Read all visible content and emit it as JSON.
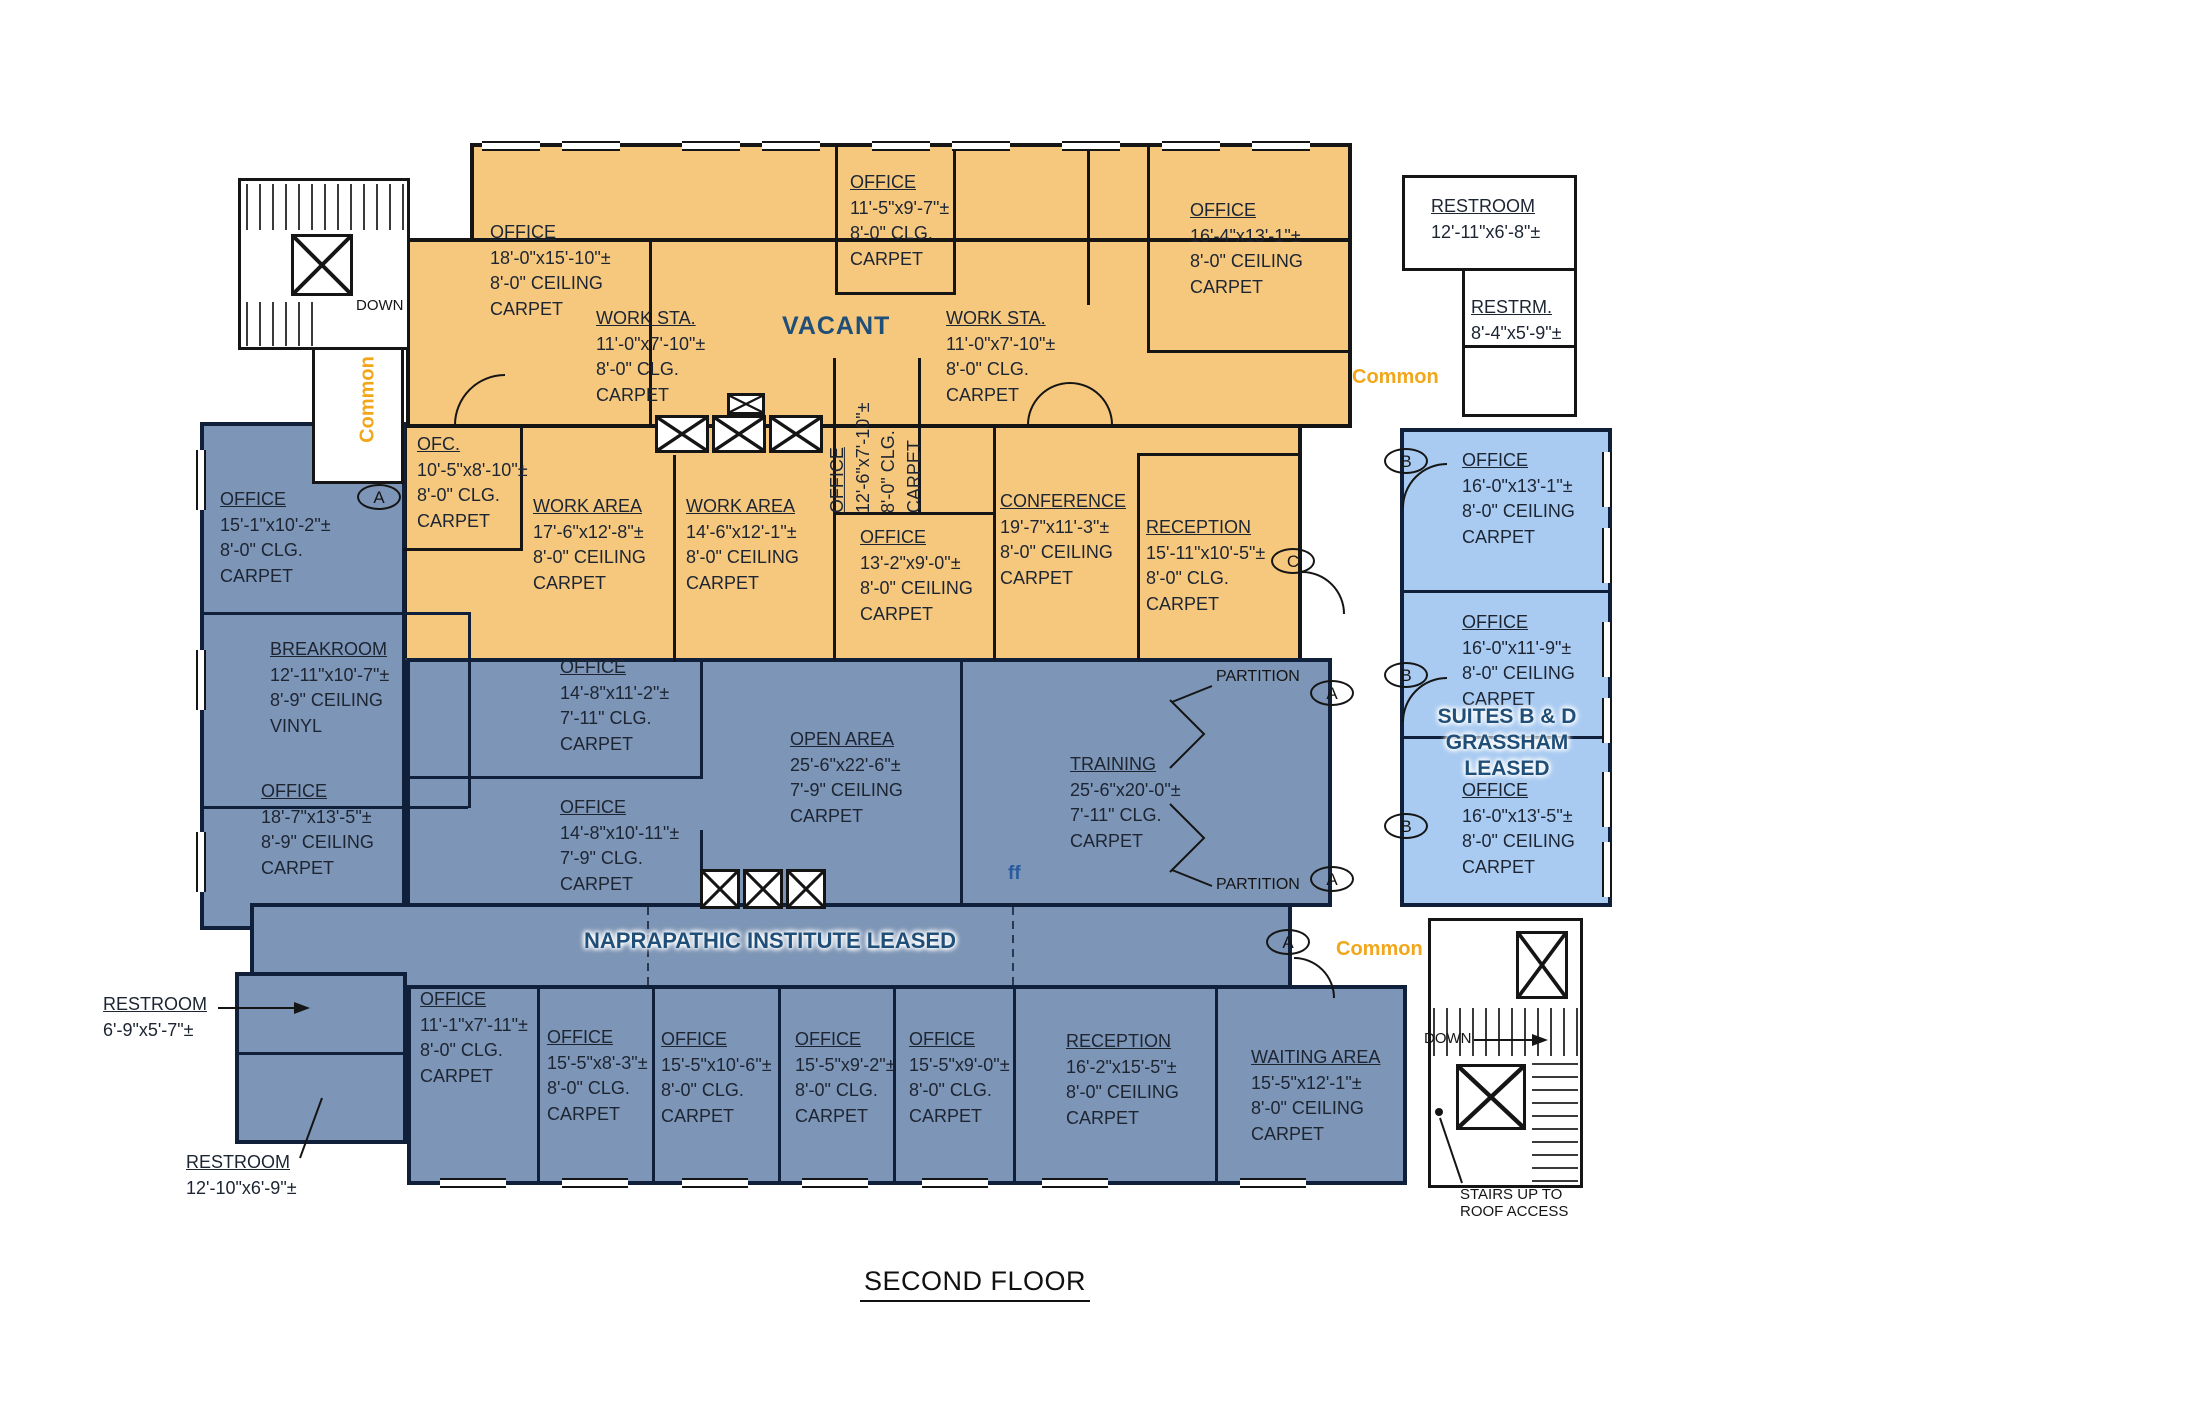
{
  "title": "SECOND FLOOR",
  "zones": {
    "vacant": {
      "name": "VACANT",
      "fill": "#F6C87E"
    },
    "naprapathic": {
      "name": "NAPRAPATHIC INSTITUTE LEASED",
      "fill": "#7D95B6"
    },
    "suites": {
      "line1": "SUITES B & D",
      "line2": "GRASSHAM",
      "line3": "LEASED",
      "fill": "#A9CBF2"
    }
  },
  "labels": {
    "common": "Common",
    "down": "DOWN",
    "partition": "PARTITION",
    "ff": "ff",
    "stairs_roof_line1": "STAIRS UP TO",
    "stairs_roof_line2": "ROOF ACCESS"
  },
  "markers": {
    "a": "A",
    "b": "B",
    "c": "C"
  },
  "rooms": [
    {
      "name": "OFFICE",
      "lines": [
        "18'-0\"x15'-10\"±",
        "8'-0\" CEILING",
        "CARPET"
      ]
    },
    {
      "name": "WORK STA.",
      "lines": [
        "11'-0\"x7'-10\"±",
        "8'-0\" CLG.",
        "CARPET"
      ]
    },
    {
      "name": "OFFICE",
      "lines": [
        "11'-5\"x9'-7\"±",
        "8'-0\" CLG.",
        "CARPET"
      ]
    },
    {
      "name": "WORK STA.",
      "lines": [
        "11'-0\"x7'-10\"±",
        "8'-0\" CLG.",
        "CARPET"
      ]
    },
    {
      "name": "OFFICE",
      "lines": [
        "16'-4\"x13'-1\"±",
        "8'-0\" CEILING",
        "CARPET"
      ]
    },
    {
      "name": "OFC.",
      "lines": [
        "10'-5\"x8'-10\"±",
        "8'-0\" CLG.",
        "CARPET"
      ]
    },
    {
      "name": "WORK AREA",
      "lines": [
        "17'-6\"x12'-8\"±",
        "8'-0\" CEILING",
        "CARPET"
      ]
    },
    {
      "name": "WORK AREA",
      "lines": [
        "14'-6\"x12'-1\"±",
        "8'-0\" CEILING",
        "CARPET"
      ]
    },
    {
      "name": "OFFICE",
      "lines": [
        "12'-6\"x7'-10\"±",
        "8'-0\" CLG.",
        "CARPET"
      ]
    },
    {
      "name": "OFFICE",
      "lines": [
        "13'-2\"x9'-0\"±",
        "8'-0\" CEILING",
        "CARPET"
      ]
    },
    {
      "name": "CONFERENCE",
      "lines": [
        "19'-7\"x11'-3\"±",
        "8'-0\" CEILING",
        "CARPET"
      ]
    },
    {
      "name": "RECEPTION",
      "lines": [
        "15'-11\"x10'-5\"±",
        "8'-0\" CLG.",
        "CARPET"
      ]
    },
    {
      "name": "OFFICE",
      "lines": [
        "15'-1\"x10'-2\"±",
        "8'-0\" CLG.",
        "CARPET"
      ]
    },
    {
      "name": "BREAKROOM",
      "lines": [
        "12'-11\"x10'-7\"±",
        "8'-9\" CEILING",
        "VINYL"
      ]
    },
    {
      "name": "OFFICE",
      "lines": [
        "18'-7\"x13'-5\"±",
        "8'-9\" CEILING",
        "CARPET"
      ]
    },
    {
      "name": "OFFICE",
      "lines": [
        "14'-8\"x11'-2\"±",
        "7'-11\" CLG.",
        "CARPET"
      ]
    },
    {
      "name": "OFFICE",
      "lines": [
        "14'-8\"x10'-11\"±",
        "7'-9\" CLG.",
        "CARPET"
      ]
    },
    {
      "name": "OPEN AREA",
      "lines": [
        "25'-6\"x22'-6\"±",
        "7'-9\" CEILING",
        "CARPET"
      ]
    },
    {
      "name": "TRAINING",
      "lines": [
        "25'-6\"x20'-0\"±",
        "7'-11\" CLG.",
        "CARPET"
      ]
    },
    {
      "name": "OFFICE",
      "lines": [
        "11'-1\"x7'-11\"±",
        "8'-0\" CLG.",
        "CARPET"
      ]
    },
    {
      "name": "OFFICE",
      "lines": [
        "15'-5\"x8'-3\"±",
        "8'-0\" CLG.",
        "CARPET"
      ]
    },
    {
      "name": "OFFICE",
      "lines": [
        "15'-5\"x10'-6\"±",
        "8'-0\" CLG.",
        "CARPET"
      ]
    },
    {
      "name": "OFFICE",
      "lines": [
        "15'-5\"x9'-2\"±",
        "8'-0\" CLG.",
        "CARPET"
      ]
    },
    {
      "name": "OFFICE",
      "lines": [
        "15'-5\"x9'-0\"±",
        "8'-0\" CLG.",
        "CARPET"
      ]
    },
    {
      "name": "RECEPTION",
      "lines": [
        "16'-2\"x15'-5\"±",
        "8'-0\" CEILING",
        "CARPET"
      ]
    },
    {
      "name": "WAITING AREA",
      "lines": [
        "15'-5\"x12'-1\"±",
        "8'-0\" CEILING",
        "CARPET"
      ]
    },
    {
      "name": "RESTROOM",
      "lines": [
        "12'-11\"x6'-8\"±"
      ]
    },
    {
      "name": "RESTRM.",
      "lines": [
        "8'-4\"x5'-9\"±"
      ]
    },
    {
      "name": "RESTROOM",
      "lines": [
        "6'-9\"x5'-7\"±"
      ]
    },
    {
      "name": "RESTROOM",
      "lines": [
        "12'-10\"x6'-9\"±"
      ]
    },
    {
      "name": "OFFICE",
      "lines": [
        "16'-0\"x13'-1\"±",
        "8'-0\" CEILING",
        "CARPET"
      ]
    },
    {
      "name": "OFFICE",
      "lines": [
        "16'-0\"x11'-9\"±",
        "8'-0\" CEILING",
        "CARPET"
      ]
    },
    {
      "name": "OFFICE",
      "lines": [
        "16'-0\"x13'-5\"±",
        "8'-0\" CEILING",
        "CARPET"
      ]
    }
  ]
}
